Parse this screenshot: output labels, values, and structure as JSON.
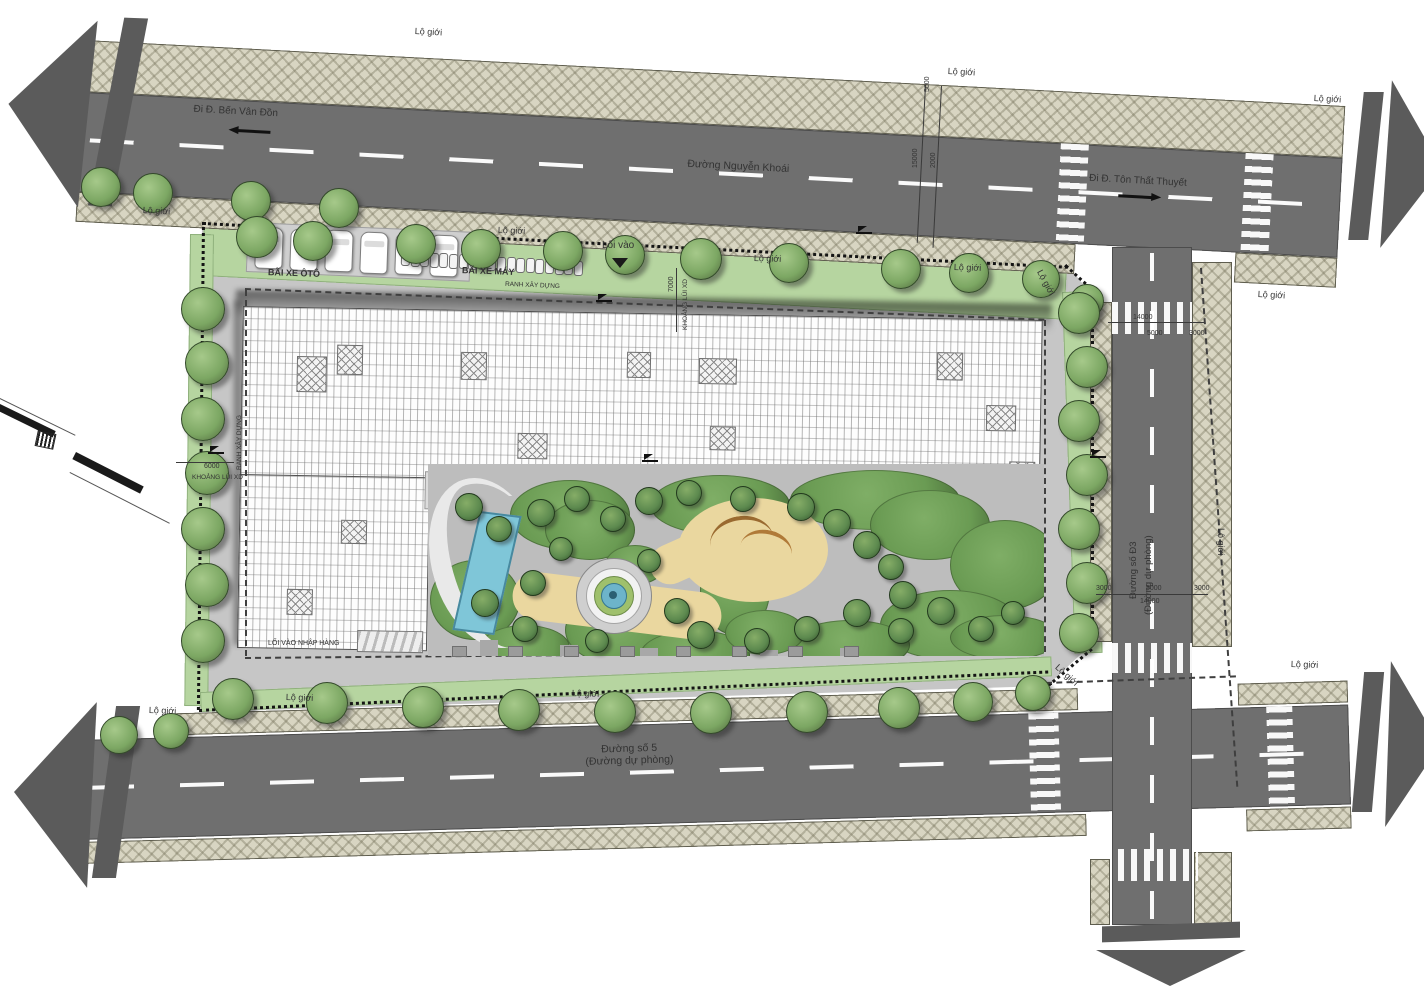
{
  "drawing": {
    "boundary_label": "Lộ giới",
    "roads": {
      "top": {
        "name": "Đường Nguyễn Khoái",
        "to_left": "Đi Đ. Bến Vân Đồn",
        "to_right": "Đi Đ. Tôn Thất Thuyết"
      },
      "bottom": {
        "name": "Đường số 5",
        "subname": "(Đường dự phòng)"
      },
      "right": {
        "name": "Đường số Đ3",
        "subname": "(Đường dự phòng)"
      }
    },
    "site": {
      "car_parking_label": "BÃI XE ÔTÔ",
      "bike_parking_label": "BÃI XE MÁY",
      "entrance_label": "Lối vào",
      "loading_entrance_label": "LỐI VÀO NHẬP HÀNG",
      "construction_line_label": "RANH XÂY DỰNG",
      "setback_label": "KHOẢNG LÙI XD"
    },
    "boundary_label_positions": [
      {
        "x": 415,
        "y": 26,
        "r": 3
      },
      {
        "x": 948,
        "y": 66,
        "r": 3
      },
      {
        "x": 1314,
        "y": 93,
        "r": 3
      },
      {
        "x": 143,
        "y": 205,
        "r": 3
      },
      {
        "x": 498,
        "y": 225,
        "r": 2
      },
      {
        "x": 754,
        "y": 253,
        "r": 2
      },
      {
        "x": 954,
        "y": 262,
        "r": 2
      },
      {
        "x": 1044,
        "y": 268,
        "r": 62
      },
      {
        "x": 1258,
        "y": 289,
        "r": 3
      },
      {
        "x": 1226,
        "y": 528,
        "r": 90
      },
      {
        "x": 1291,
        "y": 659,
        "r": 2
      },
      {
        "x": 1060,
        "y": 662,
        "r": 42
      },
      {
        "x": 149,
        "y": 705,
        "r": 2
      },
      {
        "x": 572,
        "y": 688,
        "r": 2
      },
      {
        "x": 286,
        "y": 692,
        "r": 2
      }
    ],
    "dimension_labels": [
      {
        "v": "5000",
        "x": 924,
        "y": 92,
        "r": -90
      },
      {
        "v": "15000",
        "x": 912,
        "y": 168,
        "r": -90
      },
      {
        "v": "2000",
        "x": 930,
        "y": 168,
        "r": -90
      },
      {
        "v": "14000",
        "x": 1133,
        "y": 314,
        "r": 0
      },
      {
        "v": "5000",
        "x": 1147,
        "y": 330,
        "r": 0
      },
      {
        "v": "3000",
        "x": 1189,
        "y": 330,
        "r": 0
      },
      {
        "v": "3000",
        "x": 1096,
        "y": 585,
        "r": 0
      },
      {
        "v": "5000",
        "x": 1146,
        "y": 585,
        "r": 0
      },
      {
        "v": "3000",
        "x": 1194,
        "y": 585,
        "r": 0
      },
      {
        "v": "14000",
        "x": 1140,
        "y": 598,
        "r": 0
      },
      {
        "v": "6000",
        "x": 204,
        "y": 463,
        "r": 0
      },
      {
        "v": "7000",
        "x": 668,
        "y": 292,
        "r": -90
      }
    ]
  },
  "colors": {
    "sidewalk": "#d8d5c2",
    "asphalt": "#6f6f6f",
    "parcel": "#c6c6c6",
    "green": "#b6d5a0",
    "tree": "#7ca763",
    "pool": "#7fc6d8",
    "sand_path": "#ead79f",
    "building": "#fdfdfd",
    "arrow": "#5b5b5b"
  }
}
